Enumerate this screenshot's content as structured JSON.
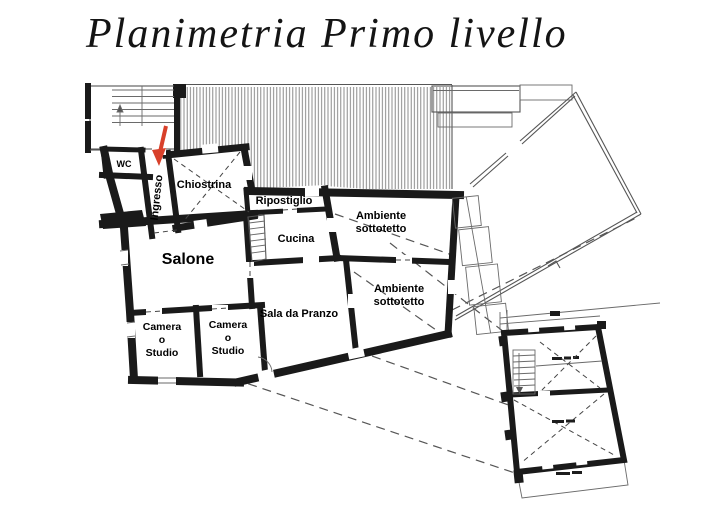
{
  "slide": {
    "title": "Planimetria Primo livello",
    "background": "#ffffff",
    "description": "First-level floor plan drawing with labeled rooms, hatched roof area, adjacent outline structures, detached stair-block plan and red entrance arrow"
  },
  "colors": {
    "wall": "#1a1a1a",
    "thin_line": "#555555",
    "hatch": "#7d7d7d",
    "dashed_line": "#555555",
    "entrance_arrow": "#d8402a",
    "label_text": "#000000"
  },
  "labels": {
    "title": "Planimetria Primo livello",
    "wc": "WC",
    "ingresso": "Ingresso",
    "chiostrina": "Chiostrina",
    "ripostiglio": "Ripostiglio",
    "cucina": "Cucina",
    "salone": "Salone",
    "sala_da_pranzo": "Sala da Pranzo",
    "ambiente_sottotetto": {
      "line1": "Ambiente",
      "line2": "sottotetto"
    },
    "camera_o_studio": {
      "line1": "Camera",
      "line2": "o",
      "line3": "Studio"
    }
  }
}
